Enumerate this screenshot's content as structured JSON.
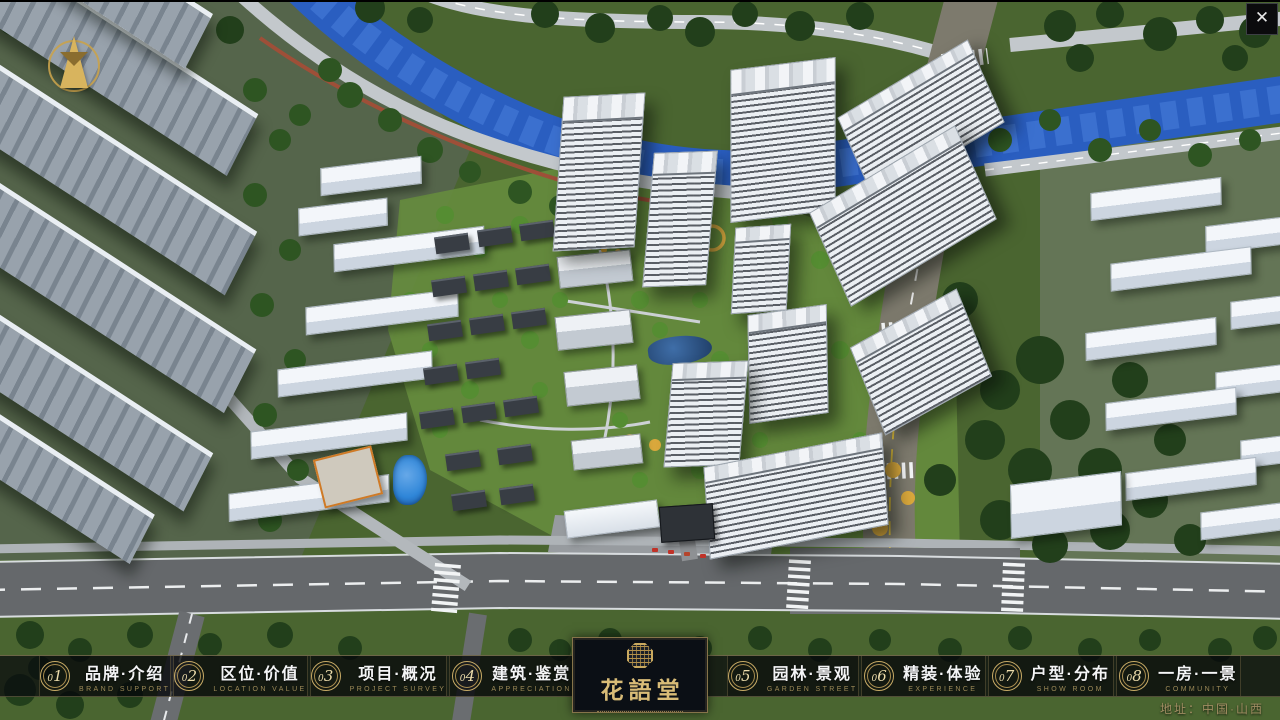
{
  "window": {
    "close": "✕"
  },
  "icons": {
    "compass": "north-arrow-compass",
    "close": "close-x",
    "seal": "brand-seal-emblem"
  },
  "nav": {
    "items": [
      {
        "num": "01",
        "label": "品牌·介绍",
        "sub": "BRAND SUPPORT"
      },
      {
        "num": "02",
        "label": "区位·价值",
        "sub": "LOCATION VALUE"
      },
      {
        "num": "03",
        "label": "项目·概况",
        "sub": "PROJECT SURVEY"
      },
      {
        "num": "04",
        "label": "建筑·鉴赏",
        "sub": "APPRECIATION"
      },
      {
        "num": "05",
        "label": "园林·景观",
        "sub": "GARDEN STREET"
      },
      {
        "num": "06",
        "label": "精装·体验",
        "sub": "EXPERIENCE"
      },
      {
        "num": "07",
        "label": "户型·分布",
        "sub": "SHOW ROOM"
      },
      {
        "num": "08",
        "label": "一房·一景",
        "sub": "COMMUNITY"
      }
    ]
  },
  "logo": {
    "title": "花語堂"
  },
  "footer": {
    "address": "地址：中国·山西"
  },
  "colors": {
    "gold": "#c9a96a",
    "gold_text": "#9d8a58",
    "bar_bg": "rgba(8,10,13,0.74)",
    "river": "#2b5fc4",
    "grass": "#5f8438",
    "forest": "#2e5522",
    "road": "#65686b"
  }
}
